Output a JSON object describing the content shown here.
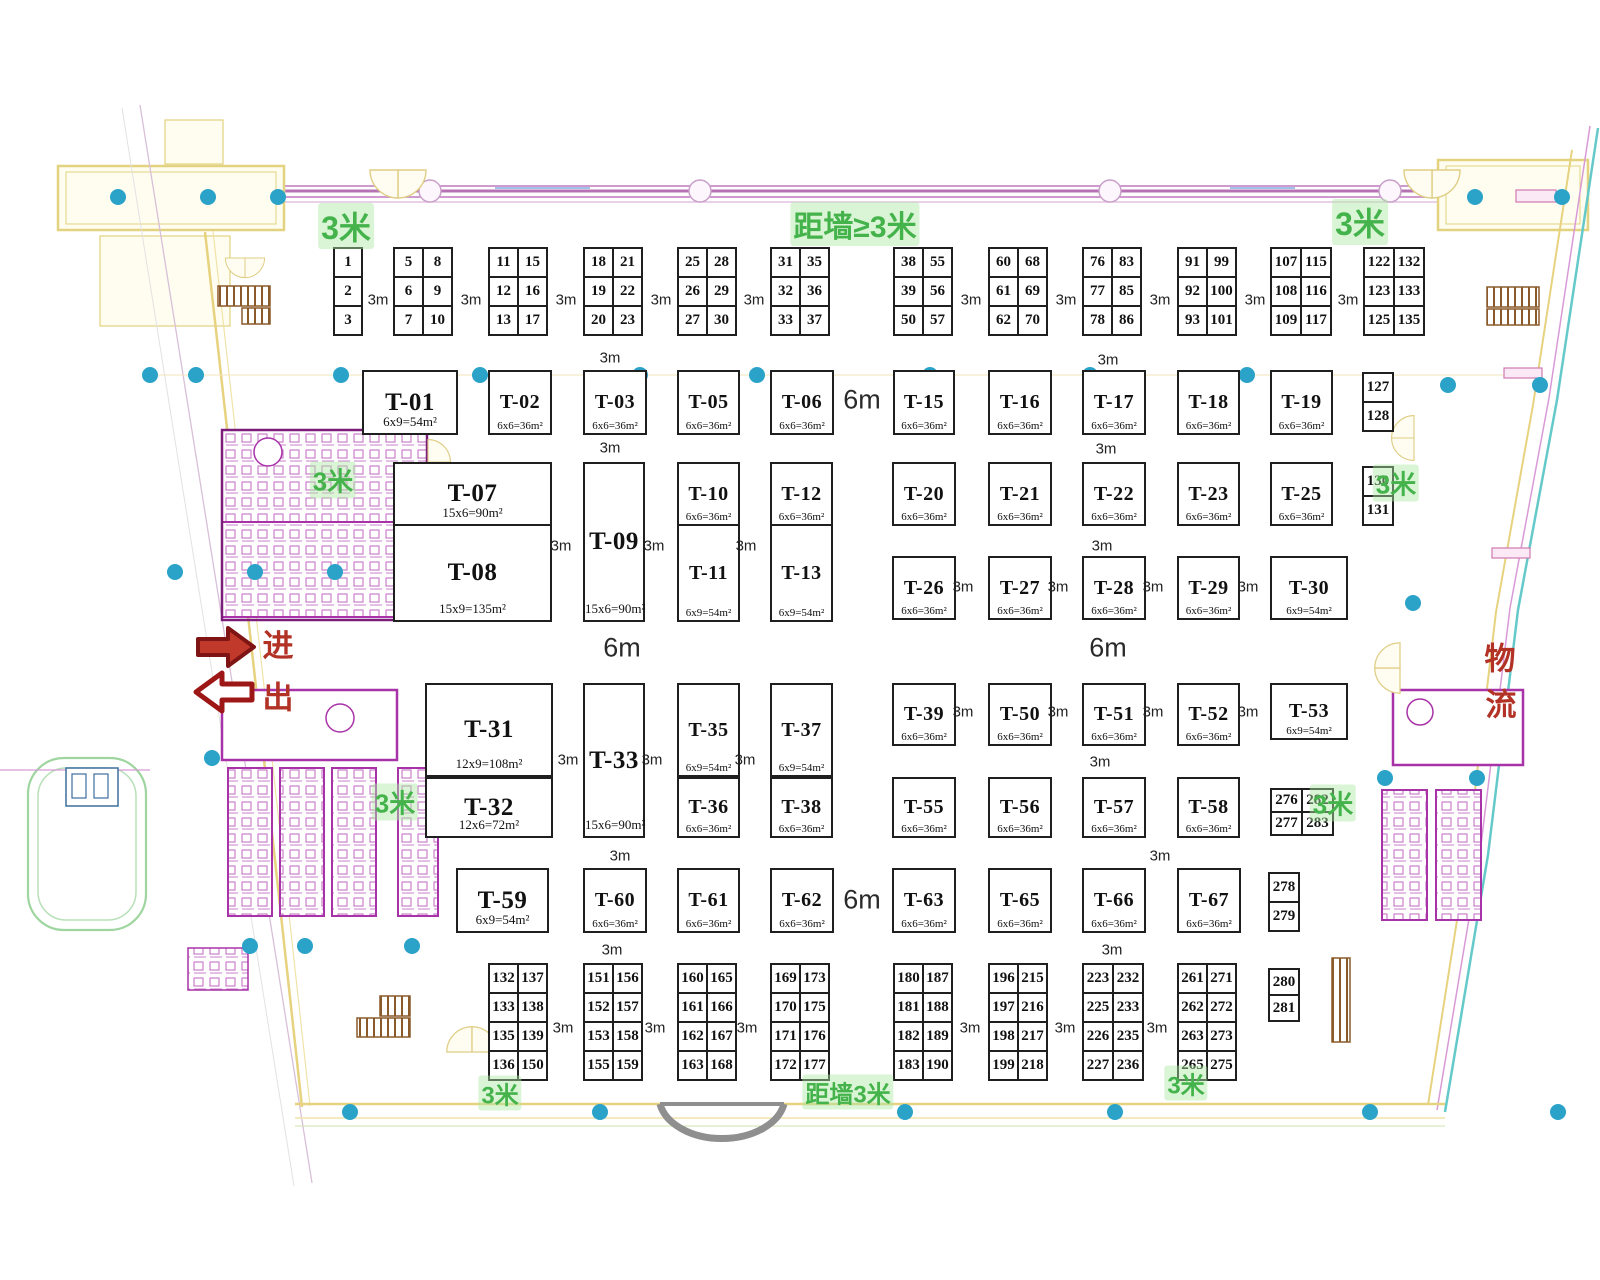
{
  "plan": {
    "width": 1600,
    "height": 1280
  },
  "colors": {
    "booth_border": "#1f1f1f",
    "green_label": "#45b34b",
    "red_annotation": "#b23226",
    "arrow_fill": "#c0392b",
    "arrow_outline": "#7e1414",
    "cyan_column_dot": "#2ba3c8",
    "corridor_pink": "#c98fc9",
    "wall_yellow": "#e6d27f",
    "stair_brown": "#8a5a2a",
    "restroom_magenta": "#b23ab2",
    "ramp_green": "#9fd6a0",
    "door_gray": "#8f8f8f"
  },
  "annotations": {
    "entry": "进",
    "exit": "出",
    "logistics_1": "物",
    "logistics_2": "流"
  },
  "green_labels": [
    {
      "t": "3米",
      "x": 346,
      "y": 226,
      "s": 32
    },
    {
      "t": "距墙≥3米",
      "x": 855,
      "y": 224,
      "s": 30
    },
    {
      "t": "3米",
      "x": 1360,
      "y": 222,
      "s": 32
    },
    {
      "t": "3米",
      "x": 333,
      "y": 480,
      "s": 26
    },
    {
      "t": "3米",
      "x": 1396,
      "y": 483,
      "s": 26
    },
    {
      "t": "3米",
      "x": 395,
      "y": 802,
      "s": 26
    },
    {
      "t": "3米",
      "x": 1333,
      "y": 803,
      "s": 26
    },
    {
      "t": "3米",
      "x": 500,
      "y": 1093,
      "s": 24
    },
    {
      "t": "距墙3米",
      "x": 848,
      "y": 1092,
      "s": 24
    },
    {
      "t": "3米",
      "x": 1186,
      "y": 1083,
      "s": 24
    }
  ],
  "booths": [
    {
      "id": "T-01",
      "size": "6x9=54m²",
      "x": 362,
      "y": 370,
      "w": 96,
      "h": 65
    },
    {
      "id": "T-02",
      "size": "6x6=36m²",
      "x": 488,
      "y": 370,
      "w": 64,
      "h": 65
    },
    {
      "id": "T-03",
      "size": "6x6=36m²",
      "x": 583,
      "y": 370,
      "w": 64,
      "h": 65
    },
    {
      "id": "T-05",
      "size": "6x6=36m²",
      "x": 677,
      "y": 370,
      "w": 63,
      "h": 65
    },
    {
      "id": "T-06",
      "size": "6x6=36m²",
      "x": 770,
      "y": 370,
      "w": 64,
      "h": 65
    },
    {
      "id": "T-15",
      "size": "6x6=36m²",
      "x": 893,
      "y": 370,
      "w": 62,
      "h": 65
    },
    {
      "id": "T-16",
      "size": "6x6=36m²",
      "x": 988,
      "y": 370,
      "w": 64,
      "h": 65
    },
    {
      "id": "T-17",
      "size": "6x6=36m²",
      "x": 1082,
      "y": 370,
      "w": 64,
      "h": 65
    },
    {
      "id": "T-18",
      "size": "6x6=36m²",
      "x": 1177,
      "y": 370,
      "w": 63,
      "h": 65
    },
    {
      "id": "T-19",
      "size": "6x6=36m²",
      "x": 1270,
      "y": 370,
      "w": 63,
      "h": 65
    },
    {
      "id": "T-07",
      "size": "15x6=90m²",
      "x": 393,
      "y": 462,
      "w": 159,
      "h": 64
    },
    {
      "id": "T-08",
      "size": "15x9=135m²",
      "x": 393,
      "y": 524,
      "w": 159,
      "h": 98
    },
    {
      "id": "T-09",
      "size": "15x6=90m²",
      "x": 583,
      "y": 462,
      "w": 62,
      "h": 160
    },
    {
      "id": "T-10",
      "size": "6x6=36m²",
      "x": 677,
      "y": 462,
      "w": 63,
      "h": 64
    },
    {
      "id": "T-11",
      "size": "6x9=54m²",
      "x": 677,
      "y": 524,
      "w": 63,
      "h": 98
    },
    {
      "id": "T-12",
      "size": "6x6=36m²",
      "x": 770,
      "y": 462,
      "w": 63,
      "h": 64
    },
    {
      "id": "T-13",
      "size": "6x9=54m²",
      "x": 770,
      "y": 524,
      "w": 63,
      "h": 98
    },
    {
      "id": "T-20",
      "size": "6x6=36m²",
      "x": 892,
      "y": 462,
      "w": 64,
      "h": 64
    },
    {
      "id": "T-21",
      "size": "6x6=36m²",
      "x": 988,
      "y": 462,
      "w": 64,
      "h": 64
    },
    {
      "id": "T-22",
      "size": "6x6=36m²",
      "x": 1082,
      "y": 462,
      "w": 64,
      "h": 64
    },
    {
      "id": "T-23",
      "size": "6x6=36m²",
      "x": 1177,
      "y": 462,
      "w": 63,
      "h": 64
    },
    {
      "id": "T-25",
      "size": "6x6=36m²",
      "x": 1270,
      "y": 462,
      "w": 63,
      "h": 64
    },
    {
      "id": "T-26",
      "size": "6x6=36m²",
      "x": 892,
      "y": 556,
      "w": 64,
      "h": 64
    },
    {
      "id": "T-27",
      "size": "6x6=36m²",
      "x": 988,
      "y": 556,
      "w": 64,
      "h": 64
    },
    {
      "id": "T-28",
      "size": "6x6=36m²",
      "x": 1082,
      "y": 556,
      "w": 64,
      "h": 64
    },
    {
      "id": "T-29",
      "size": "6x6=36m²",
      "x": 1177,
      "y": 556,
      "w": 63,
      "h": 64
    },
    {
      "id": "T-30",
      "size": "6x9=54m²",
      "x": 1270,
      "y": 556,
      "w": 78,
      "h": 64
    },
    {
      "id": "T-31",
      "size": "12x9=108m²",
      "x": 425,
      "y": 683,
      "w": 128,
      "h": 94
    },
    {
      "id": "T-32",
      "size": "12x6=72m²",
      "x": 425,
      "y": 777,
      "w": 128,
      "h": 61
    },
    {
      "id": "T-33",
      "size": "15x6=90m²",
      "x": 583,
      "y": 683,
      "w": 62,
      "h": 155
    },
    {
      "id": "T-35",
      "size": "6x9=54m²",
      "x": 677,
      "y": 683,
      "w": 63,
      "h": 94
    },
    {
      "id": "T-36",
      "size": "6x6=36m²",
      "x": 677,
      "y": 777,
      "w": 63,
      "h": 61
    },
    {
      "id": "T-37",
      "size": "6x9=54m²",
      "x": 770,
      "y": 683,
      "w": 63,
      "h": 94
    },
    {
      "id": "T-38",
      "size": "6x6=36m²",
      "x": 770,
      "y": 777,
      "w": 63,
      "h": 61
    },
    {
      "id": "T-39",
      "size": "6x6=36m²",
      "x": 892,
      "y": 683,
      "w": 64,
      "h": 63
    },
    {
      "id": "T-50",
      "size": "6x6=36m²",
      "x": 988,
      "y": 683,
      "w": 64,
      "h": 63
    },
    {
      "id": "T-51",
      "size": "6x6=36m²",
      "x": 1082,
      "y": 683,
      "w": 64,
      "h": 63
    },
    {
      "id": "T-52",
      "size": "6x6=36m²",
      "x": 1177,
      "y": 683,
      "w": 63,
      "h": 63
    },
    {
      "id": "T-53",
      "size": "6x9=54m²",
      "x": 1270,
      "y": 683,
      "w": 78,
      "h": 57
    },
    {
      "id": "T-55",
      "size": "6x6=36m²",
      "x": 892,
      "y": 777,
      "w": 64,
      "h": 61
    },
    {
      "id": "T-56",
      "size": "6x6=36m²",
      "x": 988,
      "y": 777,
      "w": 64,
      "h": 61
    },
    {
      "id": "T-57",
      "size": "6x6=36m²",
      "x": 1082,
      "y": 777,
      "w": 64,
      "h": 61
    },
    {
      "id": "T-58",
      "size": "6x6=36m²",
      "x": 1177,
      "y": 777,
      "w": 63,
      "h": 61
    },
    {
      "id": "T-59",
      "size": "6x9=54m²",
      "x": 456,
      "y": 868,
      "w": 93,
      "h": 65
    },
    {
      "id": "T-60",
      "size": "6x6=36m²",
      "x": 583,
      "y": 868,
      "w": 64,
      "h": 65
    },
    {
      "id": "T-61",
      "size": "6x6=36m²",
      "x": 677,
      "y": 868,
      "w": 63,
      "h": 65
    },
    {
      "id": "T-62",
      "size": "6x6=36m²",
      "x": 770,
      "y": 868,
      "w": 64,
      "h": 65
    },
    {
      "id": "T-63",
      "size": "6x6=36m²",
      "x": 892,
      "y": 868,
      "w": 64,
      "h": 65
    },
    {
      "id": "T-65",
      "size": "6x6=36m²",
      "x": 988,
      "y": 868,
      "w": 64,
      "h": 65
    },
    {
      "id": "T-66",
      "size": "6x6=36m²",
      "x": 1082,
      "y": 868,
      "w": 64,
      "h": 65
    },
    {
      "id": "T-67",
      "size": "6x6=36m²",
      "x": 1177,
      "y": 868,
      "w": 64,
      "h": 65
    }
  ],
  "number_grids": [
    {
      "x": 333,
      "y": 247,
      "cw": 30,
      "ch": 31,
      "rows": [
        [
          "1"
        ],
        [
          "2"
        ],
        [
          "3"
        ]
      ]
    },
    {
      "x": 393,
      "y": 247,
      "cw": 31,
      "ch": 31,
      "rows": [
        [
          "5",
          "8"
        ],
        [
          "6",
          "9"
        ],
        [
          "7",
          "10"
        ]
      ]
    },
    {
      "x": 488,
      "y": 247,
      "cw": 31,
      "ch": 31,
      "rows": [
        [
          "11",
          "15"
        ],
        [
          "12",
          "16"
        ],
        [
          "13",
          "17"
        ]
      ]
    },
    {
      "x": 583,
      "y": 247,
      "cw": 31,
      "ch": 31,
      "rows": [
        [
          "18",
          "21"
        ],
        [
          "19",
          "22"
        ],
        [
          "20",
          "23"
        ]
      ]
    },
    {
      "x": 677,
      "y": 247,
      "cw": 31,
      "ch": 31,
      "rows": [
        [
          "25",
          "28"
        ],
        [
          "26",
          "29"
        ],
        [
          "27",
          "30"
        ]
      ]
    },
    {
      "x": 770,
      "y": 247,
      "cw": 31,
      "ch": 31,
      "rows": [
        [
          "31",
          "35"
        ],
        [
          "32",
          "36"
        ],
        [
          "33",
          "37"
        ]
      ]
    },
    {
      "x": 893,
      "y": 247,
      "cw": 31,
      "ch": 31,
      "rows": [
        [
          "38",
          "55"
        ],
        [
          "39",
          "56"
        ],
        [
          "50",
          "57"
        ]
      ]
    },
    {
      "x": 988,
      "y": 247,
      "cw": 31,
      "ch": 31,
      "rows": [
        [
          "60",
          "68"
        ],
        [
          "61",
          "69"
        ],
        [
          "62",
          "70"
        ]
      ]
    },
    {
      "x": 1082,
      "y": 247,
      "cw": 31,
      "ch": 31,
      "rows": [
        [
          "76",
          "83"
        ],
        [
          "77",
          "85"
        ],
        [
          "78",
          "86"
        ]
      ]
    },
    {
      "x": 1177,
      "y": 247,
      "cw": 31,
      "ch": 31,
      "rows": [
        [
          "91",
          "99"
        ],
        [
          "92",
          "100"
        ],
        [
          "93",
          "101"
        ]
      ]
    },
    {
      "x": 1270,
      "y": 247,
      "cw": 32,
      "ch": 31,
      "rows": [
        [
          "107",
          "115"
        ],
        [
          "108",
          "116"
        ],
        [
          "109",
          "117"
        ]
      ]
    },
    {
      "x": 1363,
      "y": 247,
      "cw": 32,
      "ch": 31,
      "rows": [
        [
          "122",
          "132"
        ],
        [
          "123",
          "133"
        ],
        [
          "125",
          "135"
        ]
      ]
    },
    {
      "x": 1362,
      "y": 372,
      "cw": 32,
      "ch": 31,
      "rows": [
        [
          "127"
        ],
        [
          "128"
        ]
      ]
    },
    {
      "x": 1362,
      "y": 466,
      "cw": 32,
      "ch": 31,
      "rows": [
        [
          "130"
        ],
        [
          "131"
        ]
      ]
    },
    {
      "x": 1270,
      "y": 788,
      "cw": 33,
      "ch": 25,
      "rows": [
        [
          "276",
          "282"
        ],
        [
          "277",
          "283"
        ]
      ]
    },
    {
      "x": 1268,
      "y": 872,
      "cw": 32,
      "ch": 31,
      "rows": [
        [
          "278"
        ],
        [
          "279"
        ]
      ]
    },
    {
      "x": 1268,
      "y": 968,
      "cw": 32,
      "ch": 28,
      "rows": [
        [
          "280"
        ],
        [
          "281"
        ]
      ]
    },
    {
      "x": 488,
      "y": 963,
      "cw": 31,
      "ch": 31,
      "rows": [
        [
          "132",
          "137"
        ],
        [
          "133",
          "138"
        ],
        [
          "135",
          "139"
        ],
        [
          "136",
          "150"
        ]
      ]
    },
    {
      "x": 583,
      "y": 963,
      "cw": 31,
      "ch": 31,
      "rows": [
        [
          "151",
          "156"
        ],
        [
          "152",
          "157"
        ],
        [
          "153",
          "158"
        ],
        [
          "155",
          "159"
        ]
      ]
    },
    {
      "x": 677,
      "y": 963,
      "cw": 31,
      "ch": 31,
      "rows": [
        [
          "160",
          "165"
        ],
        [
          "161",
          "166"
        ],
        [
          "162",
          "167"
        ],
        [
          "163",
          "168"
        ]
      ]
    },
    {
      "x": 770,
      "y": 963,
      "cw": 31,
      "ch": 31,
      "rows": [
        [
          "169",
          "173"
        ],
        [
          "170",
          "175"
        ],
        [
          "171",
          "176"
        ],
        [
          "172",
          "177"
        ]
      ]
    },
    {
      "x": 893,
      "y": 963,
      "cw": 31,
      "ch": 31,
      "rows": [
        [
          "180",
          "187"
        ],
        [
          "181",
          "188"
        ],
        [
          "182",
          "189"
        ],
        [
          "183",
          "190"
        ]
      ]
    },
    {
      "x": 988,
      "y": 963,
      "cw": 31,
      "ch": 31,
      "rows": [
        [
          "196",
          "215"
        ],
        [
          "197",
          "216"
        ],
        [
          "198",
          "217"
        ],
        [
          "199",
          "218"
        ]
      ]
    },
    {
      "x": 1082,
      "y": 963,
      "cw": 32,
      "ch": 31,
      "rows": [
        [
          "223",
          "232"
        ],
        [
          "225",
          "233"
        ],
        [
          "226",
          "235"
        ],
        [
          "227",
          "236"
        ]
      ]
    },
    {
      "x": 1177,
      "y": 963,
      "cw": 31,
      "ch": 31,
      "rows": [
        [
          "261",
          "271"
        ],
        [
          "262",
          "272"
        ],
        [
          "263",
          "273"
        ],
        [
          "265",
          "275"
        ]
      ]
    }
  ],
  "dim_labels": [
    {
      "t": "3m",
      "x": 378,
      "y": 300
    },
    {
      "t": "3m",
      "x": 471,
      "y": 300
    },
    {
      "t": "3m",
      "x": 566,
      "y": 300
    },
    {
      "t": "3m",
      "x": 661,
      "y": 300
    },
    {
      "t": "3m",
      "x": 754,
      "y": 300
    },
    {
      "t": "3m",
      "x": 971,
      "y": 300
    },
    {
      "t": "3m",
      "x": 1066,
      "y": 300
    },
    {
      "t": "3m",
      "x": 1160,
      "y": 300
    },
    {
      "t": "3m",
      "x": 1255,
      "y": 300
    },
    {
      "t": "3m",
      "x": 1348,
      "y": 300
    },
    {
      "t": "3m",
      "x": 610,
      "y": 358
    },
    {
      "t": "3m",
      "x": 1108,
      "y": 360
    },
    {
      "t": "6m",
      "x": 862,
      "y": 400,
      "big": true
    },
    {
      "t": "3m",
      "x": 610,
      "y": 448
    },
    {
      "t": "3m",
      "x": 1106,
      "y": 449
    },
    {
      "t": "3m",
      "x": 561,
      "y": 546
    },
    {
      "t": "3m",
      "x": 654,
      "y": 546
    },
    {
      "t": "3m",
      "x": 746,
      "y": 546
    },
    {
      "t": "3m",
      "x": 1102,
      "y": 546
    },
    {
      "t": "3m",
      "x": 963,
      "y": 587
    },
    {
      "t": "3m",
      "x": 1058,
      "y": 587
    },
    {
      "t": "3m",
      "x": 1153,
      "y": 587
    },
    {
      "t": "3m",
      "x": 1248,
      "y": 587
    },
    {
      "t": "6m",
      "x": 622,
      "y": 648,
      "big": true
    },
    {
      "t": "6m",
      "x": 1108,
      "y": 648,
      "big": true
    },
    {
      "t": "3m",
      "x": 963,
      "y": 712
    },
    {
      "t": "3m",
      "x": 1058,
      "y": 712
    },
    {
      "t": "3m",
      "x": 1153,
      "y": 712
    },
    {
      "t": "3m",
      "x": 1248,
      "y": 712
    },
    {
      "t": "3m",
      "x": 568,
      "y": 760
    },
    {
      "t": "3m",
      "x": 652,
      "y": 760
    },
    {
      "t": "3m",
      "x": 745,
      "y": 760
    },
    {
      "t": "3m",
      "x": 1100,
      "y": 762
    },
    {
      "t": "3m",
      "x": 620,
      "y": 856
    },
    {
      "t": "3m",
      "x": 1160,
      "y": 856
    },
    {
      "t": "6m",
      "x": 862,
      "y": 900,
      "big": true
    },
    {
      "t": "3m",
      "x": 612,
      "y": 950
    },
    {
      "t": "3m",
      "x": 1112,
      "y": 950
    },
    {
      "t": "3m",
      "x": 563,
      "y": 1028
    },
    {
      "t": "3m",
      "x": 655,
      "y": 1028
    },
    {
      "t": "3m",
      "x": 747,
      "y": 1028
    },
    {
      "t": "3m",
      "x": 970,
      "y": 1028
    },
    {
      "t": "3m",
      "x": 1065,
      "y": 1028
    },
    {
      "t": "3m",
      "x": 1157,
      "y": 1028
    }
  ],
  "column_dots": [
    [
      118,
      197
    ],
    [
      208,
      197
    ],
    [
      278,
      197
    ],
    [
      1475,
      197
    ],
    [
      1562,
      197
    ],
    [
      150,
      375
    ],
    [
      196,
      375
    ],
    [
      341,
      375
    ],
    [
      480,
      375
    ],
    [
      640,
      375
    ],
    [
      757,
      375
    ],
    [
      930,
      375
    ],
    [
      1090,
      375
    ],
    [
      1247,
      375
    ],
    [
      1448,
      385
    ],
    [
      1540,
      385
    ],
    [
      175,
      572
    ],
    [
      255,
      572
    ],
    [
      335,
      572
    ],
    [
      212,
      758
    ],
    [
      1413,
      603
    ],
    [
      1385,
      778
    ],
    [
      1477,
      778
    ],
    [
      250,
      946
    ],
    [
      305,
      946
    ],
    [
      412,
      946
    ],
    [
      350,
      1112
    ],
    [
      600,
      1112
    ],
    [
      905,
      1112
    ],
    [
      1115,
      1112
    ],
    [
      1370,
      1112
    ],
    [
      1558,
      1112
    ]
  ]
}
